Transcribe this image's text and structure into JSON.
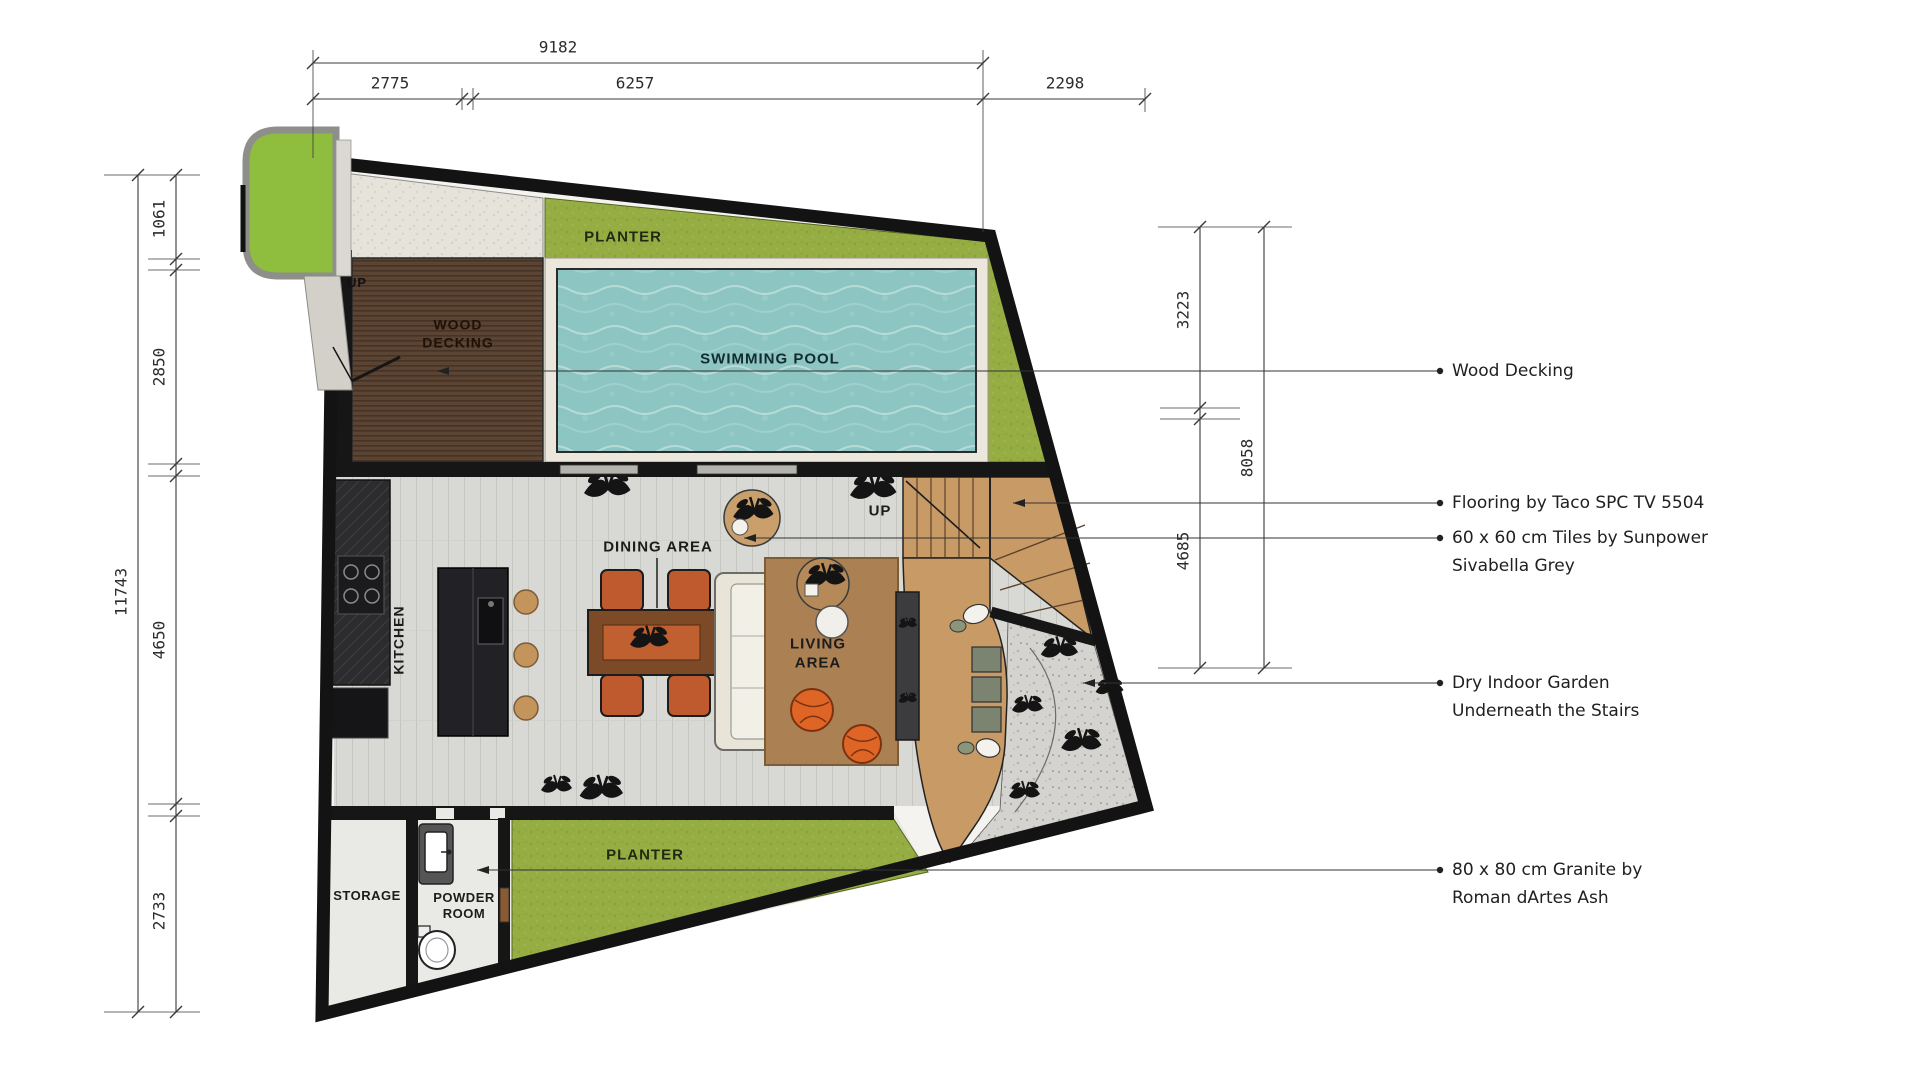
{
  "labels": {
    "planter_top": "PLANTER",
    "planter_bottom": "PLANTER",
    "wood_decking_l1": "WOOD",
    "wood_decking_l2": "DECKING",
    "swimming_pool": "SWIMMING POOL",
    "kitchen": "KITCHEN",
    "dining_area": "DINING AREA",
    "living_l1": "LIVING",
    "living_l2": "AREA",
    "storage": "STORAGE",
    "powder_l1": "POWDER",
    "powder_l2": "ROOM",
    "up_entry": "UP",
    "up_stairs": "UP"
  },
  "dimensions": {
    "top": {
      "overall": "9182",
      "seg1": "2775",
      "seg2": "6257",
      "seg3": "2298"
    },
    "left": {
      "overall": "11743",
      "seg1": "1061",
      "seg2": "2850",
      "seg3": "4650",
      "seg4": "2733"
    },
    "right": {
      "seg1": "3223",
      "seg2": "4685",
      "overall": "8058"
    }
  },
  "annotations": {
    "wood_decking": "Wood Decking",
    "flooring": "Flooring by Taco SPC TV 5504",
    "tiles_l1": "60 x 60 cm Tiles by Sunpower",
    "tiles_l2": "Sivabella Grey",
    "garden_l1": "Dry Indoor Garden",
    "garden_l2": "Underneath the Stairs",
    "granite_l1": "80 x 80 cm Granite by",
    "granite_l2": "Roman dArtes Ash"
  },
  "colors": {
    "wall": "#161616",
    "planter_green": "#95ad43",
    "pool_water": "#8cc5c1",
    "pool_deck": "#ebe7dc",
    "wood_decking": "#5c4433",
    "stair_wood": "#c89a66",
    "tile_floor": "#d8d8d4",
    "gravel": "#d5d3cf",
    "rug": "#ab8153",
    "pouf_orange": "#df6526",
    "chair_orange": "#bf5a2e"
  }
}
